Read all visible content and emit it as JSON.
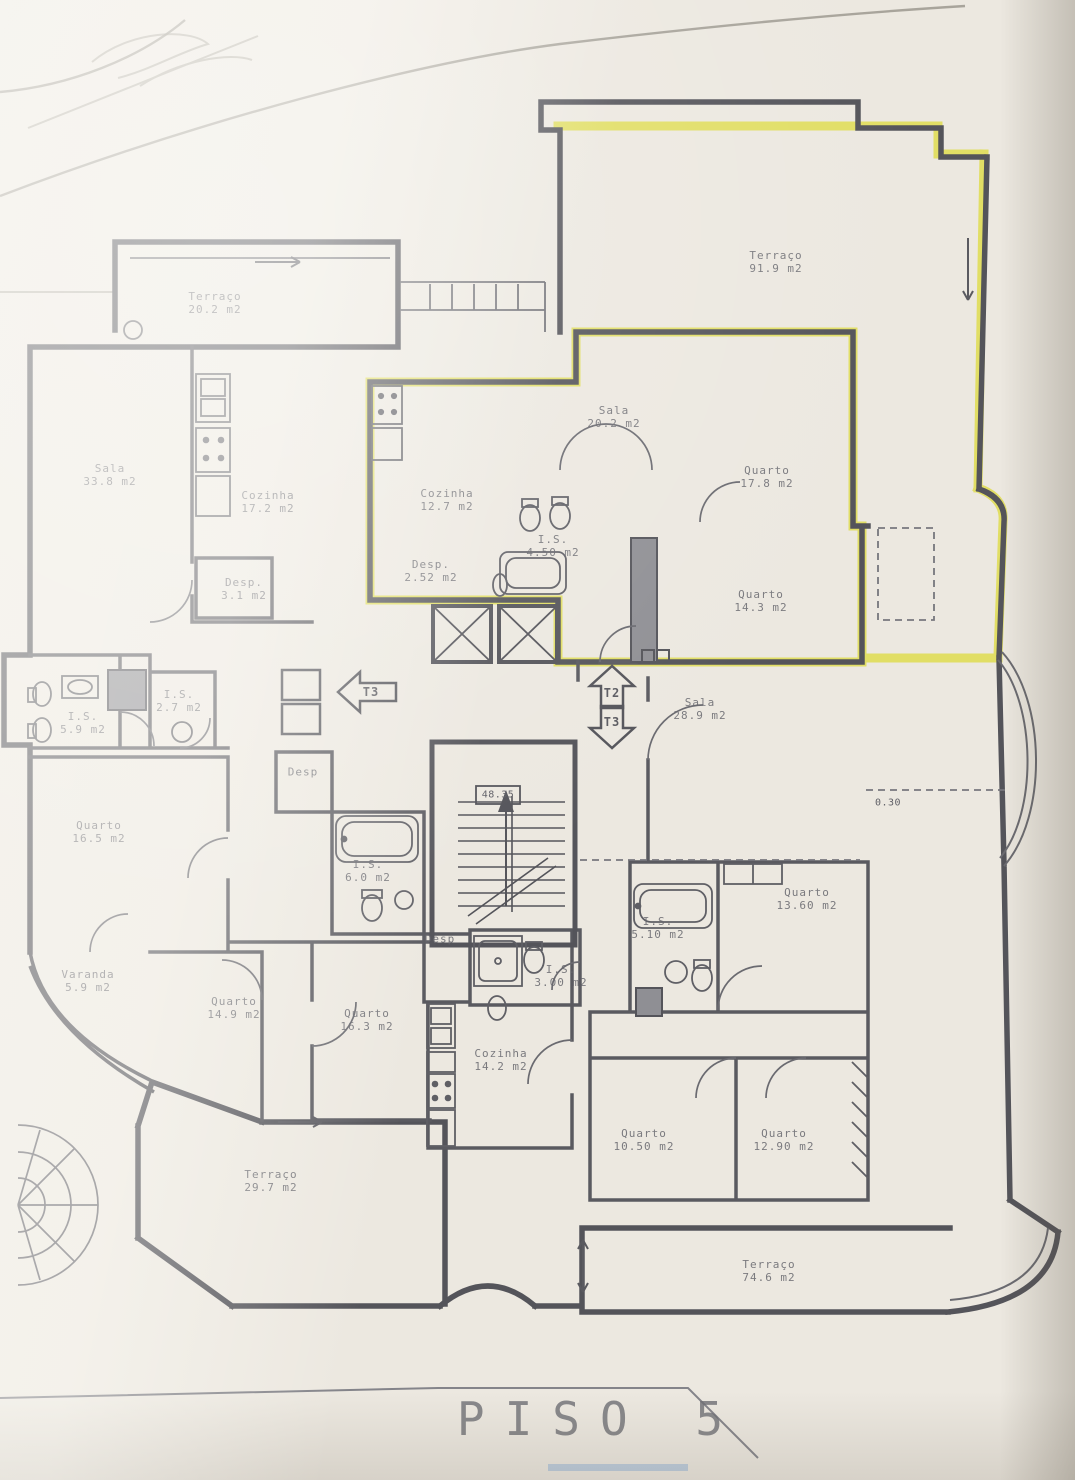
{
  "document": {
    "title": "PISO 5"
  },
  "annotations": {
    "stair_level": "48.35",
    "dimension": "0.30"
  },
  "colors": {
    "highlight": "#e0dd5e",
    "walls": "#54545a",
    "paper": "#ece8e0",
    "labels": "#67676e"
  },
  "markers": [
    {
      "label": "T3",
      "x": 371,
      "y": 692,
      "direction": "left"
    },
    {
      "label": "T2",
      "x": 612,
      "y": 693,
      "direction": "up"
    },
    {
      "label": "T3",
      "x": 612,
      "y": 722,
      "direction": "down"
    }
  ],
  "rooms": [
    {
      "name": "Terraço",
      "area": "20.2 m2",
      "x": 215,
      "y": 303,
      "highlighted": false
    },
    {
      "name": "Terraço",
      "area": "91.9 m2",
      "x": 776,
      "y": 262,
      "highlighted": true
    },
    {
      "name": "Sala",
      "area": "33.8 m2",
      "x": 110,
      "y": 475,
      "highlighted": false
    },
    {
      "name": "Cozinha",
      "area": "17.2 m2",
      "x": 268,
      "y": 502,
      "highlighted": false
    },
    {
      "name": "Cozinha",
      "area": "12.7 m2",
      "x": 447,
      "y": 500,
      "highlighted": true
    },
    {
      "name": "Desp.",
      "area": "2.52 m2",
      "x": 431,
      "y": 571,
      "highlighted": true
    },
    {
      "name": "I.S.",
      "area": "4.50 m2",
      "x": 553,
      "y": 546,
      "highlighted": true
    },
    {
      "name": "Desp.",
      "area": "3.1 m2",
      "x": 244,
      "y": 589,
      "highlighted": false
    },
    {
      "name": "Sala",
      "area": "20.2 m2",
      "x": 614,
      "y": 417,
      "highlighted": true
    },
    {
      "name": "Quarto",
      "area": "17.8 m2",
      "x": 767,
      "y": 477,
      "highlighted": true
    },
    {
      "name": "Quarto",
      "area": "14.3 m2",
      "x": 761,
      "y": 601,
      "highlighted": true
    },
    {
      "name": "Sala",
      "area": "28.9 m2",
      "x": 700,
      "y": 709,
      "highlighted": false
    },
    {
      "name": "I.S.",
      "area": "5.9 m2",
      "x": 83,
      "y": 723,
      "highlighted": false
    },
    {
      "name": "I.S.",
      "area": "2.7 m2",
      "x": 179,
      "y": 701,
      "highlighted": false
    },
    {
      "name": "Quarto",
      "area": "16.5 m2",
      "x": 99,
      "y": 832,
      "highlighted": false
    },
    {
      "name": "Desp",
      "area": "",
      "x": 303,
      "y": 772,
      "highlighted": false
    },
    {
      "name": "I.S.",
      "area": "6.0 m2",
      "x": 368,
      "y": 871,
      "highlighted": false
    },
    {
      "name": "Quarto",
      "area": "13.60 m2",
      "x": 807,
      "y": 899,
      "highlighted": false
    },
    {
      "name": "I.S.",
      "area": "5.10 m2",
      "x": 658,
      "y": 928,
      "highlighted": false
    },
    {
      "name": "Varanda",
      "area": "5.9 m2",
      "x": 88,
      "y": 981,
      "highlighted": false
    },
    {
      "name": "Quarto",
      "area": "14.9 m2",
      "x": 234,
      "y": 1008,
      "highlighted": false
    },
    {
      "name": "Quarto",
      "area": "16.3 m2",
      "x": 367,
      "y": 1020,
      "highlighted": false
    },
    {
      "name": "Desp",
      "area": "",
      "x": 440,
      "y": 939,
      "highlighted": false
    },
    {
      "name": "I.S.",
      "area": "3.00 m2",
      "x": 561,
      "y": 976,
      "highlighted": false
    },
    {
      "name": "Cozinha",
      "area": "14.2 m2",
      "x": 501,
      "y": 1060,
      "highlighted": false
    },
    {
      "name": "Quarto",
      "area": "10.50 m2",
      "x": 644,
      "y": 1140,
      "highlighted": false
    },
    {
      "name": "Quarto",
      "area": "12.90 m2",
      "x": 784,
      "y": 1140,
      "highlighted": false
    },
    {
      "name": "Terraço",
      "area": "29.7 m2",
      "x": 271,
      "y": 1181,
      "highlighted": false
    },
    {
      "name": "Terraço",
      "area": "74.6 m2",
      "x": 769,
      "y": 1271,
      "highlighted": false
    }
  ]
}
